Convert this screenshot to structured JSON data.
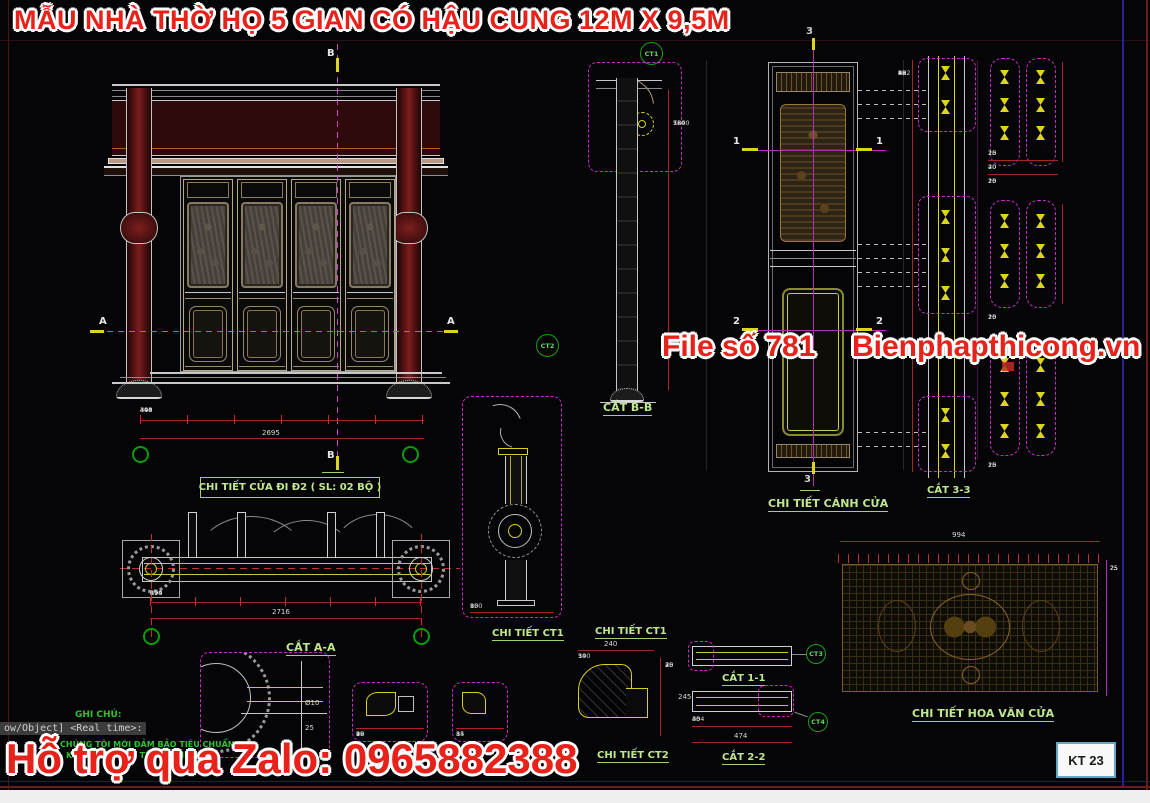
{
  "title": "MẪU NHÀ THỜ HỌ 5 GIAN CÓ HẬU CUNG 12M X 9,5M",
  "watermark": {
    "file_no": "File số 781",
    "website": "Bienphapthicong.vn",
    "zalo": "Hỗ trợ qua Zalo: 0965882388"
  },
  "sheet": {
    "number": "KT 23"
  },
  "labels": {
    "door_detail": "CHI TIẾT CỬA ĐI Đ2 ( SL: 02 BỘ )",
    "cut_aa": "CẮT A-A",
    "cut_bb": "CẮT B-B",
    "cut_11": "CẮT 1-1",
    "cut_22": "CẮT 2-2",
    "cut_33": "CẮT 3-3",
    "detail_ct1_a": "CHI TIẾT CT1",
    "detail_ct1_b": "CHI TIẾT CT1",
    "detail_ct2": "CHI TIẾT CT2",
    "door_leaf_detail": "CHI TIẾT CÁNH CỬA",
    "door_pattern_detail": "CHI TIẾT HOA VĂN CỬA"
  },
  "markers": {
    "a": "A",
    "b": "B",
    "s1": "1",
    "s2": "2",
    "s3": "3",
    "ct1": "CT1",
    "ct2": "CT2",
    "ct3": "CT3",
    "ct4": "CT4"
  },
  "notes": {
    "heading": "GHI CHÚ:",
    "line1": "CHÚNG TÔI MỚI ĐẢM BẢO TIÊU CHUẨN",
    "line2": "- KIỂM TRA THỰC TẾ KHI THI CÔNG",
    "command_overlay": "ow/Object] <Real time>:"
  },
  "dims": {
    "facade": {
      "chain": [
        "340",
        "494",
        "493",
        "494",
        "494",
        "340"
      ],
      "total": "2695"
    },
    "plan": {
      "chain": [
        "370",
        "494",
        "494",
        "494",
        "494",
        "370"
      ],
      "total": "2716"
    },
    "section_bb": {
      "chain": [
        "580",
        "1240",
        "760"
      ]
    },
    "leaf_33": {
      "chain": [
        "40",
        "82",
        "38",
        "952",
        "38",
        "82",
        "40"
      ]
    },
    "ct1a": {
      "chain": [
        "80",
        "150",
        "80"
      ]
    },
    "ct1b": {
      "total": "240",
      "chain": [
        "30",
        "140",
        "50"
      ],
      "side": [
        "25",
        "75",
        "30",
        "40"
      ],
      "side_total": "245"
    },
    "bars": {
      "chain": [
        "30",
        "40",
        "334",
        "40",
        "30"
      ],
      "total": "474"
    },
    "hoavan": {
      "total": "994",
      "top_ticks": [
        "25",
        "25",
        "25",
        "25",
        "25",
        "25",
        "25",
        "25",
        "25",
        "25",
        "25",
        "25",
        "25",
        "25",
        "25",
        "25",
        "25",
        "25",
        "25",
        "25",
        "25",
        "25",
        "25",
        "25",
        "25",
        "25"
      ],
      "side_ticks": [
        "25",
        "25",
        "25",
        "25",
        "25",
        "25",
        "25",
        "25",
        "25"
      ]
    },
    "right_details": {
      "row1": [
        "10",
        "25",
        "25",
        "10"
      ],
      "row2": [
        "20",
        "40",
        "20"
      ],
      "row3": [
        "10",
        "20",
        "25",
        "20",
        "10"
      ]
    },
    "small_box1": {
      "chain": [
        "95",
        "10",
        "26",
        "49"
      ]
    },
    "small_box2": {
      "chain": [
        "14",
        "8",
        "35"
      ]
    },
    "misc": {
      "dia": "Ø10",
      "v25": "25"
    }
  }
}
